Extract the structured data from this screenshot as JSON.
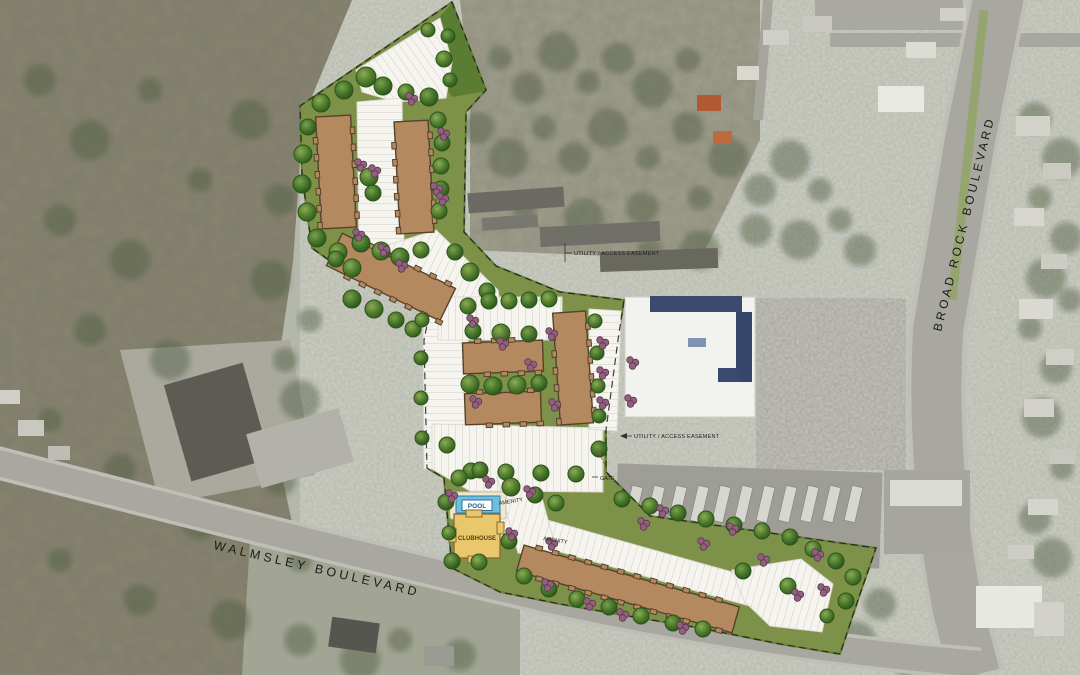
{
  "map": {
    "roads": {
      "walmsley_label": "WALMSLEY BOULEVARD",
      "broad_rock_label": "BROAD ROCK BOULEVARD"
    },
    "annotations": {
      "utility_easement_north": "UTILITY / ACCESS EASEMENT",
      "utility_easement_south": "UTILITY / ACCESS EASEMENT",
      "gate": "GATE"
    },
    "amenities": {
      "pool_label": "POOL",
      "clubhouse_label": "CLUBHOUSE",
      "amenity_label_north": "AMENITY",
      "amenity_label_south": "AMENITY"
    },
    "colors": {
      "building_brown": "#b5895f",
      "building_outline": "#54422c",
      "clubhouse_yellow": "#e9c76c",
      "pool_blue": "#6cc0de",
      "site_green": "#7e9149",
      "site_green_dark": "#5b7c33",
      "tree_green": "#4e7c2c",
      "shrub_purple": "#92607e",
      "parking_white": "#f6f4ef",
      "aerial_forest": "#87836f",
      "aerial_urban": "#b4b7ab",
      "road_gray": "#a8a8a0"
    }
  }
}
